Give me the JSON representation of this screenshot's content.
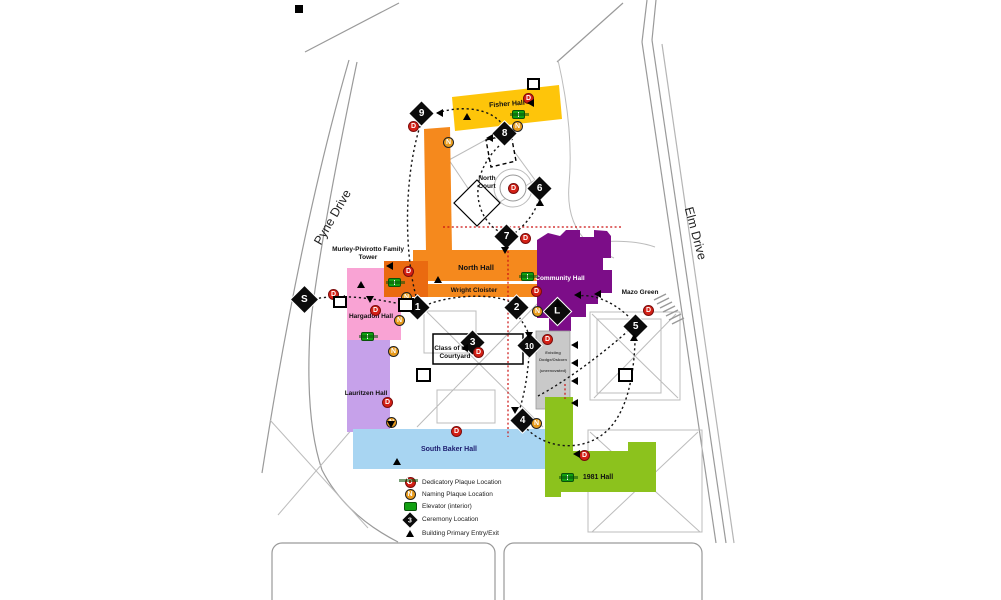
{
  "roads": {
    "pyne": "Pyne Drive",
    "elm": "Elm Drive"
  },
  "places": {
    "fisher": "Fisher Hall",
    "north_court": "North Court",
    "murley": "Murley-Pivirotto Family Tower",
    "north_hall": "North Hall",
    "wright": "Wright Cloister",
    "community": "Community Hall",
    "mazo": "Mazo Green",
    "hargadon": "Hargadon Hall",
    "courtyard_1963": "Class of 1963 Courtyard",
    "lauritzen": "Lauritzen Hall",
    "south_baker": "South Baker Hall",
    "hall_1981": "1981 Hall",
    "dodge_line1": "Existing",
    "dodge_line2": "Dodge/Osborn",
    "dodge_line3": "(unrenovated)"
  },
  "markers": {
    "s": "S",
    "l": "L",
    "n1": "1",
    "n2": "2",
    "n3": "3",
    "n4": "4",
    "n5": "5",
    "n6": "6",
    "n7": "7",
    "n8": "8",
    "n9": "9",
    "n10": "10"
  },
  "symbols": {
    "dedicatory": "D",
    "naming": "N",
    "legend_ceremony": "3"
  },
  "legend": {
    "items": [
      {
        "label": "Dedicatory Plaque Location"
      },
      {
        "label": "Naming Plaque Location"
      },
      {
        "label": "Elevator (interior)"
      },
      {
        "label": "Ceremony Location"
      },
      {
        "label": "Building Primary Entry/Exit"
      }
    ]
  },
  "colors": {
    "fisher": "#fec50a",
    "north_hall": "#f5891d",
    "wright": "#f5891d",
    "tower": "#ea6a10",
    "hargadon": "#f9a3d4",
    "lauritzen": "#c6a1ea",
    "community": "#7c0d88",
    "south_baker": "#a8d5f2",
    "hall_1981": "#8cc21d",
    "dodge": "#c9c9c9",
    "dedicatory": "#d42015",
    "naming": "#e89b1c",
    "elevator": "#12a012",
    "route_red": "#cc1111"
  }
}
